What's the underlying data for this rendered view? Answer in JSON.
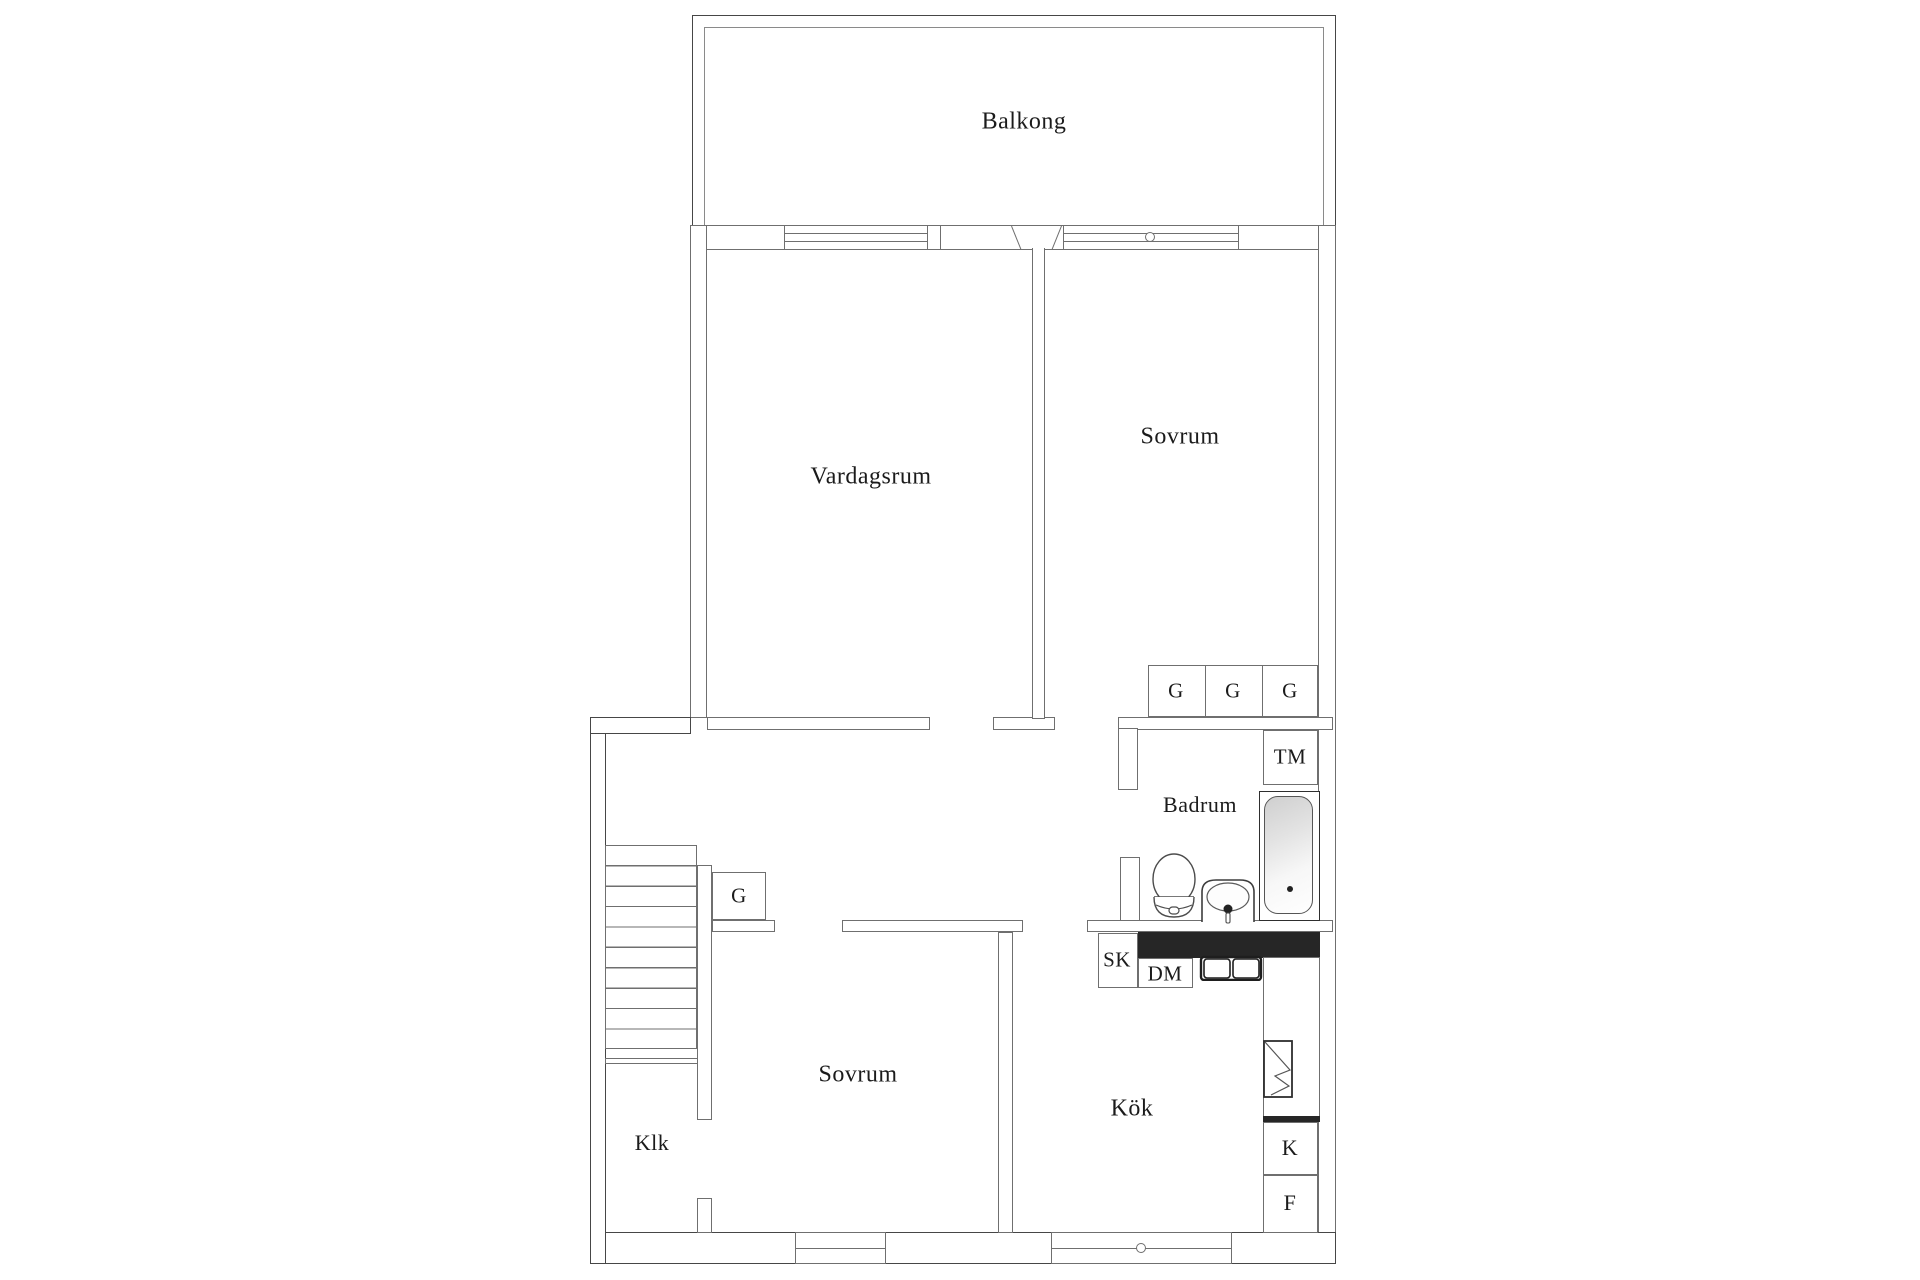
{
  "plan": {
    "labels": {
      "balcony": "Balkong",
      "living_room": "Vardagsrum",
      "bedroom_top": "Sovrum",
      "bedroom_bottom": "Sovrum",
      "bathroom": "Badrum",
      "kitchen": "Kök",
      "closet_room": "Klk",
      "wardrobes": [
        "G",
        "G",
        "G"
      ],
      "hall_wardrobe": "G",
      "washing_machine": "TM",
      "cabinet": "SK",
      "dishwasher": "DM",
      "fridge": "K",
      "freezer": "F"
    },
    "colors": {
      "background": "#ffffff",
      "outer_wall": "#464646",
      "inner_wall": "#6f6f6f",
      "text": "#1b1b1b",
      "counter": "#262626",
      "tub_shade": "#d7d7d7"
    }
  }
}
